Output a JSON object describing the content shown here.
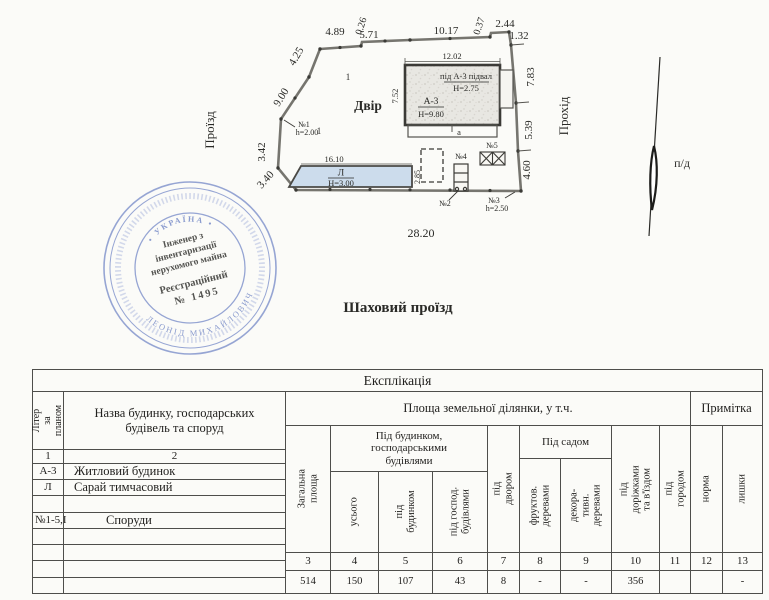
{
  "plan": {
    "labels": {
      "proizd": "Проїзд",
      "prokhid": "Прохід",
      "dvir": "Двір",
      "pd": "п/д",
      "street": "Шаховий проїзд",
      "mark1": "1",
      "mark2": "1"
    },
    "dims": {
      "top": [
        "4.89",
        "0.26",
        "5.71",
        "10.17",
        "0.37",
        "2.44",
        "1.32"
      ],
      "left": [
        "4.25",
        "9.00",
        "3.42",
        "3.40"
      ],
      "right": [
        "7.83",
        "5.39",
        "4.60"
      ],
      "bottom": "28.20"
    },
    "house": {
      "top": "12.02",
      "left": "7.52",
      "basement_title": "під А-3 підвал",
      "basement_height": "Н=2.75",
      "liter": "А-3",
      "height": "Н=9.80",
      "terrace": "а"
    },
    "shed": {
      "top": "16.10",
      "right": "2.85",
      "liter": "Л",
      "height": "Н=3.00"
    },
    "ann": {
      "n1": "№1",
      "n1h": "h=2.00",
      "n2": "№2",
      "n3": "№3",
      "n3h": "h=2.50",
      "n4": "№4",
      "n5": "№5"
    }
  },
  "stamp": {
    "country": "• УКРАЇНА •",
    "line1": "Інженер з",
    "line2": "інвентаризації",
    "line3": "нерухомого майна",
    "reg1": "Реєстраційний",
    "reg2": "№ 1495",
    "name_ring": "ЛЕОНІД МИХАЙЛОВИЧ"
  },
  "table": {
    "title": "Експлікація",
    "col1_header": "Літер за\nпланом",
    "col2_header": "Назва будинку, господарських\nбудівель та споруд",
    "area_header": "Площа земельної ділянки, у т.ч.",
    "note_header": "Примітка",
    "group_building": "Під будинком,\nгосподарськими\nбудівлями",
    "group_garden": "Під садом",
    "col3": "Загальна\nплоща",
    "col4": "усього",
    "col5": "під\nбудинком",
    "col6": "під господ.\nбудівлями",
    "col7": "під двором",
    "col8": "фруктов.\nдеревами",
    "col9": "декора-\nтивн.\nдеревами",
    "col10": "під доріжками\nта в'їздом",
    "col11": "під городом",
    "col12": "норма",
    "col13": "лишки",
    "left_nums": [
      "1",
      "2"
    ],
    "rows": [
      {
        "liter": "А-3",
        "name": "Житловий будинок"
      },
      {
        "liter": "Л",
        "name": "Сарай тимчасовий"
      },
      {
        "liter": "",
        "name": ""
      },
      {
        "liter": "№1-5,І",
        "name": "Споруди"
      },
      {
        "liter": "",
        "name": ""
      },
      {
        "liter": "",
        "name": ""
      },
      {
        "liter": "",
        "name": ""
      },
      {
        "liter": "",
        "name": ""
      }
    ],
    "col_nums": [
      "3",
      "4",
      "5",
      "6",
      "7",
      "8",
      "9",
      "10",
      "11",
      "12",
      "13"
    ],
    "values": [
      "514",
      "150",
      "107",
      "43",
      "8",
      "-",
      "-",
      "356",
      "",
      "",
      "-"
    ]
  }
}
